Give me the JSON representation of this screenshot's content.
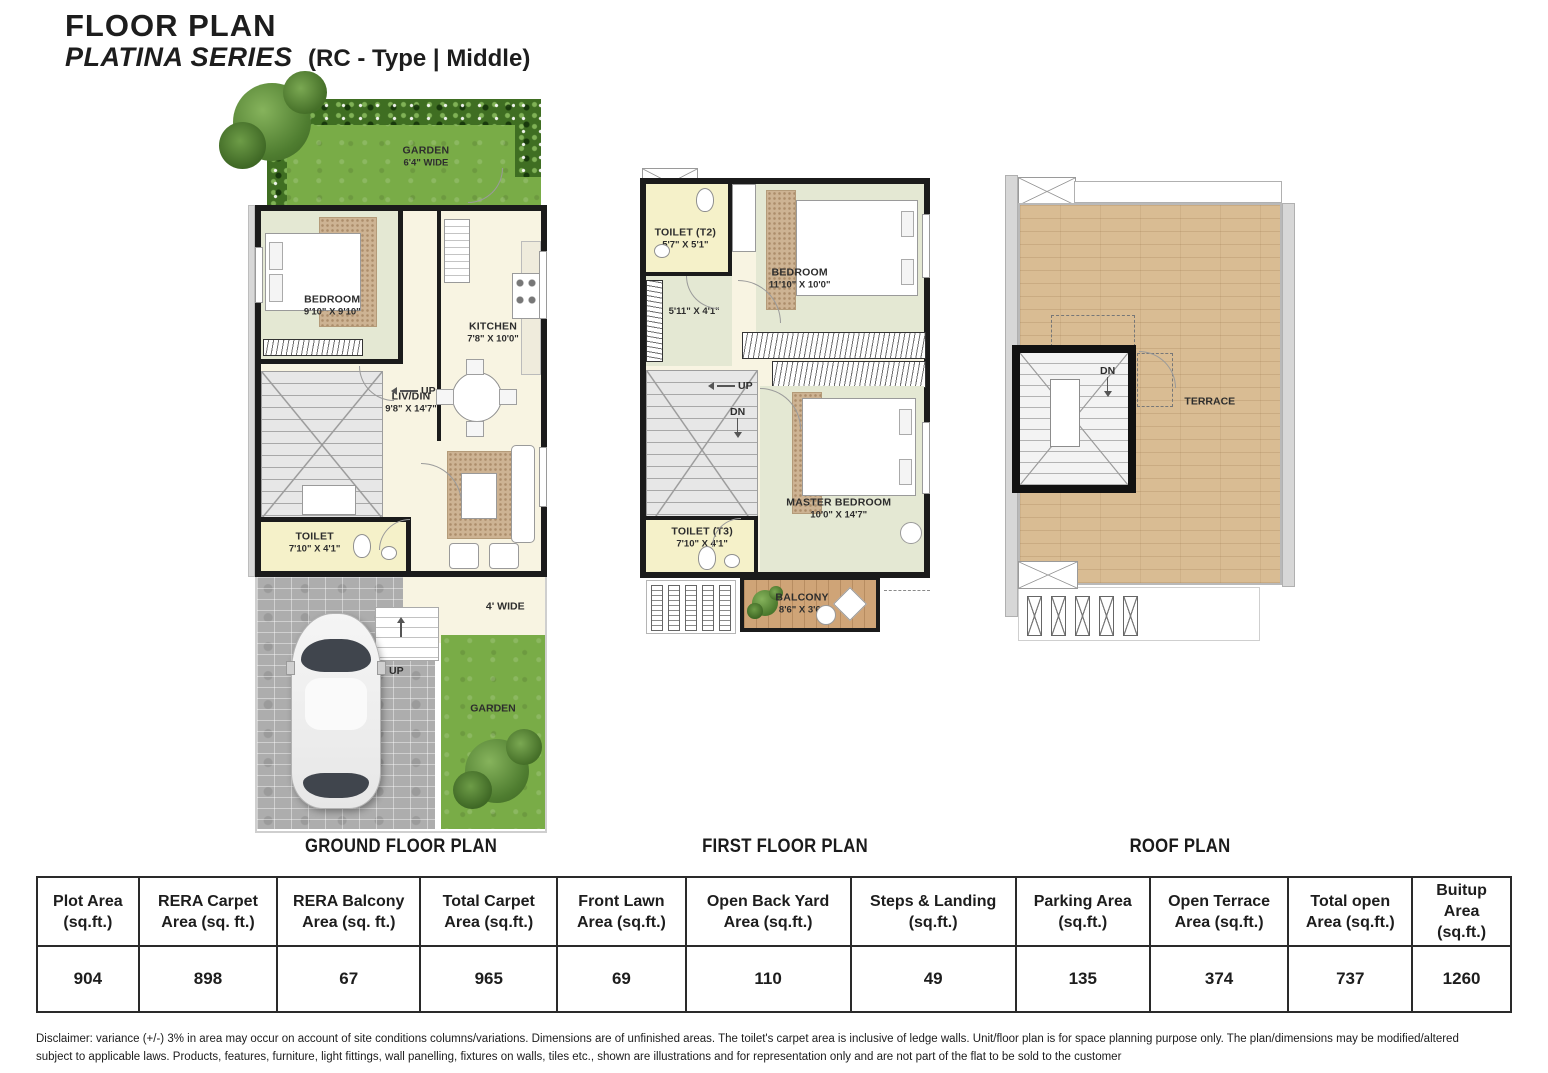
{
  "header": {
    "title": "FLOOR PLAN",
    "series": "PLATINA SERIES",
    "type_info": "(RC - Type | Middle)"
  },
  "captions": {
    "ground": "GROUND FLOOR PLAN",
    "first": "FIRST FLOOR PLAN",
    "roof": "ROOF PLAN"
  },
  "ground": {
    "garden": {
      "name": "GARDEN",
      "dim": "6'4\" WIDE"
    },
    "bedroom": {
      "name": "BEDROOM",
      "dim": "9'10\" X 9'10\""
    },
    "kitchen": {
      "name": "KITCHEN",
      "dim": "7'8\" X 10'0\""
    },
    "livdin": {
      "name": "LIV/DIN",
      "dim": "9'8\" X 14'7\""
    },
    "toilet": {
      "name": "TOILET",
      "dim": "7'10\" X 4'1\""
    },
    "up_stairs": "UP",
    "up_entry": "UP",
    "walkway": "4' WIDE",
    "garden_back": "GARDEN"
  },
  "first": {
    "toilet_t2": {
      "name": "TOILET (T2)",
      "dim": "5'7\" X 5'1\""
    },
    "bedroom": {
      "name": "BEDROOM",
      "dim": "11'10\" X 10'0\""
    },
    "passage_dim": "5'11\" X 4'1\"",
    "up": "UP",
    "dn": "DN",
    "toilet_t3": {
      "name": "TOILET (T3)",
      "dim": "7'10\" X 4'1\""
    },
    "master": {
      "name": "MASTER BEDROOM",
      "dim": "10'0\" X 14'7\""
    },
    "balcony": {
      "name": "BALCONY",
      "dim": "8'6\" X 3'6\""
    }
  },
  "roof": {
    "terrace": "TERRACE",
    "dn": "DN"
  },
  "table": {
    "headers": [
      "Plot Area (sq.ft.)",
      "RERA Carpet Area (sq. ft.)",
      "RERA Balcony Area (sq. ft.)",
      "Total Carpet Area (sq.ft.)",
      "Front Lawn Area (sq.ft.)",
      "Open Back Yard Area (sq.ft.)",
      "Steps & Landing (sq.ft.)",
      "Parking Area (sq.ft.)",
      "Open Terrace Area (sq.ft.)",
      "Total open Area (sq.ft.)",
      "Buitup Area (sq.ft.)"
    ],
    "values": [
      "904",
      "898",
      "67",
      "965",
      "69",
      "110",
      "49",
      "135",
      "374",
      "737",
      "1260"
    ]
  },
  "disclaimer": {
    "line1": "Disclaimer: variance (+/-) 3% in area may occur on account of site conditions columns/variations. Dimensions are of unfinished areas. The toilet's carpet area is inclusive of ledge walls. Unit/floor plan is for space planning purpose only. The plan/dimensions may be modified/altered",
    "line2": "subject to applicable laws. Products, features, furniture, light fittings, wall panelling, fixtures on walls, tiles etc., shown are illustrations and for representation only and are not part of the flat to be sold to the customer"
  },
  "colors": {
    "wall": "#1b1b1b",
    "room_green": "#e4e8d3",
    "cream": "#f8f4e2",
    "toilet_yellow": "#f5f1c9",
    "grass": "#79ac47",
    "wood": "#d9bc93"
  }
}
